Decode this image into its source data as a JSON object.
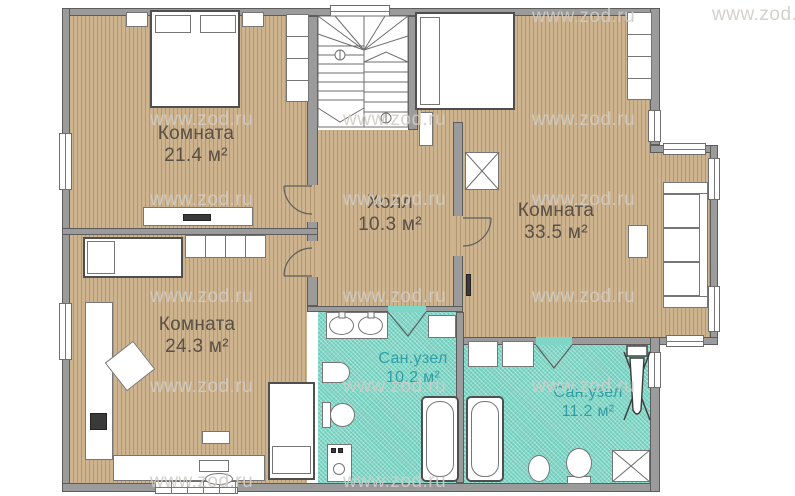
{
  "title": "План этажа",
  "watermark": {
    "text": "www.zod.ru"
  },
  "rooms": [
    {
      "id": "room-21",
      "name": "Комната",
      "area": "21.4 м²"
    },
    {
      "id": "hall",
      "name": "Холл",
      "area": "10.3 м²"
    },
    {
      "id": "room-33",
      "name": "Комната",
      "area": "33.5 м²"
    },
    {
      "id": "room-24",
      "name": "Комната",
      "area": "24.3 м²"
    },
    {
      "id": "bath-10",
      "name": "Сан.узел",
      "area": "10.2 м²"
    },
    {
      "id": "bath-11",
      "name": "Сан.узел",
      "area": "11.2 м²"
    }
  ],
  "colors": {
    "floor_wood": "#cbb18c",
    "floor_wood_stripe": "#b29772",
    "floor_bath": "#7ed7c6",
    "wall": "#9b9b9b",
    "room_label": "#5a5046",
    "bath_label": "#2f9fa6",
    "watermark": "#cfccc7"
  }
}
